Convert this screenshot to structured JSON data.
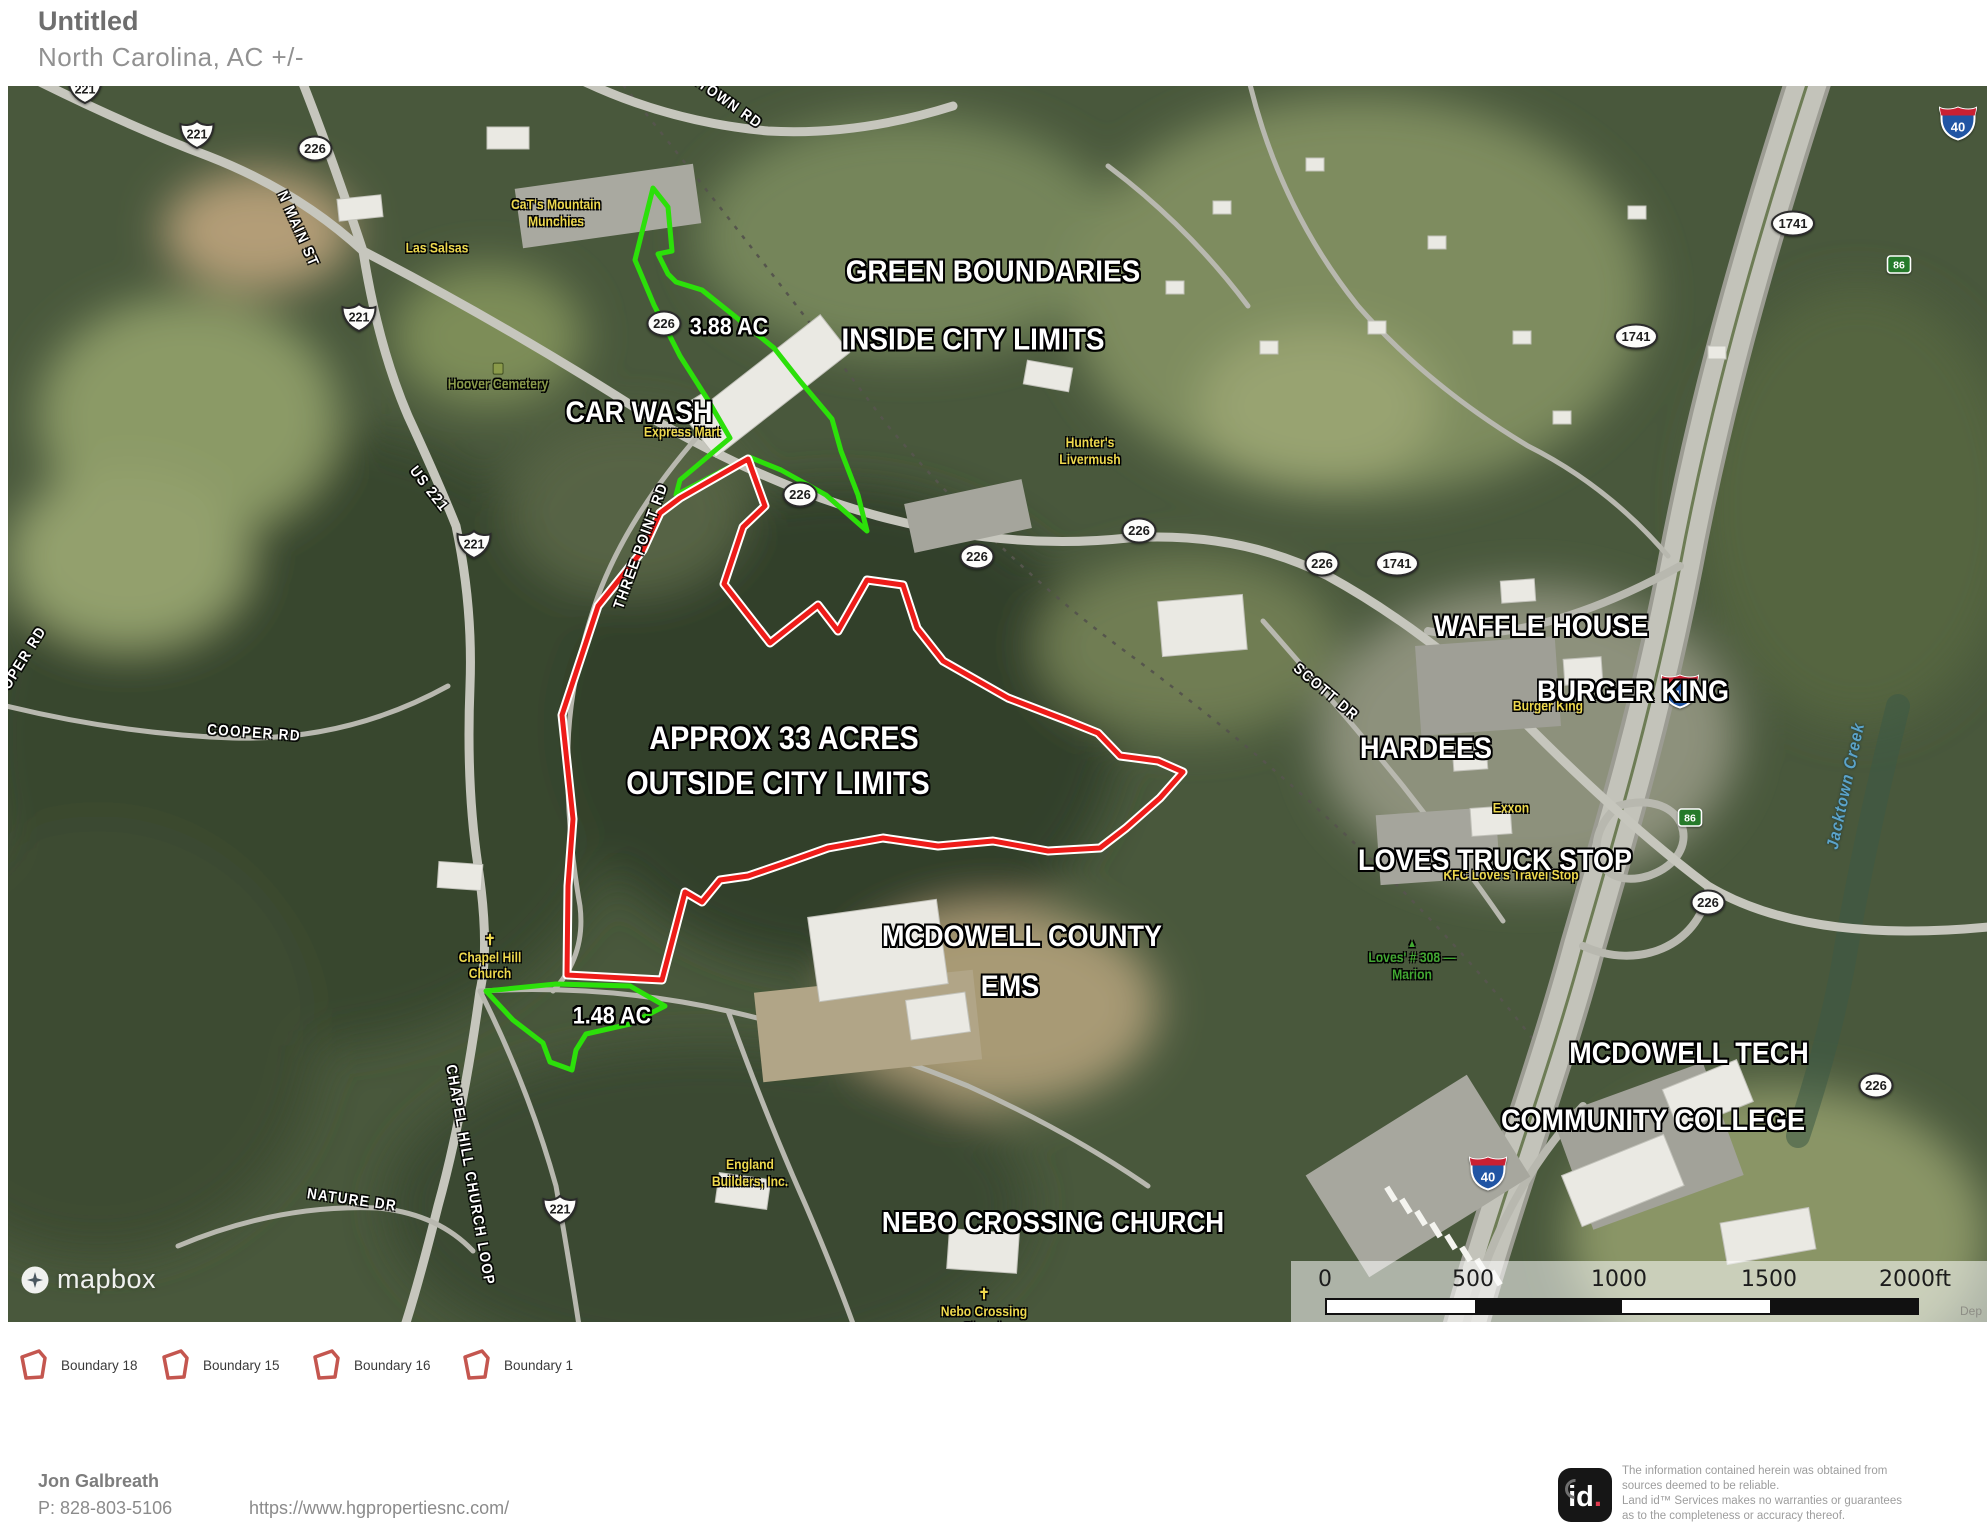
{
  "header": {
    "title": "Untitled",
    "subtitle": "North Carolina,  AC +/-"
  },
  "map": {
    "attribution": "mapbox",
    "area_labels": [
      {
        "text": "CAR WASH",
        "x": 631,
        "y": 327,
        "size": 30
      },
      {
        "text": "3.88 AC",
        "x": 721,
        "y": 242,
        "size": 24
      },
      {
        "text": "GREEN BOUNDARIES",
        "x": 985,
        "y": 186,
        "size": 31
      },
      {
        "text": "INSIDE CITY LIMITS",
        "x": 965,
        "y": 254,
        "size": 31
      },
      {
        "text": "APPROX 33 ACRES",
        "x": 776,
        "y": 653,
        "size": 32
      },
      {
        "text": "OUTSIDE CITY LIMITS",
        "x": 770,
        "y": 698,
        "size": 32
      },
      {
        "text": "MCDOWELL COUNTY",
        "x": 1014,
        "y": 851,
        "size": 30
      },
      {
        "text": "EMS",
        "x": 1002,
        "y": 901,
        "size": 30
      },
      {
        "text": "1.48 AC",
        "x": 604,
        "y": 931,
        "size": 24
      },
      {
        "text": "WAFFLE HOUSE",
        "x": 1533,
        "y": 541,
        "size": 30
      },
      {
        "text": "BURGER KING",
        "x": 1625,
        "y": 606,
        "size": 30
      },
      {
        "text": "HARDEES",
        "x": 1418,
        "y": 663,
        "size": 30
      },
      {
        "text": "LOVES TRUCK STOP",
        "x": 1487,
        "y": 775,
        "size": 30
      },
      {
        "text": "MCDOWELL TECH",
        "x": 1681,
        "y": 968,
        "size": 30
      },
      {
        "text": "COMMUNITY COLLEGE",
        "x": 1645,
        "y": 1035,
        "size": 30
      },
      {
        "text": "NEBO CROSSING CHURCH",
        "x": 1045,
        "y": 1137,
        "size": 29
      }
    ],
    "road_labels": [
      {
        "text": "JACKTOWN RD",
        "x": 705,
        "y": 6,
        "rot": 35
      },
      {
        "text": "N MAIN ST",
        "x": 290,
        "y": 143,
        "rot": 66
      },
      {
        "text": "US 221",
        "x": 421,
        "y": 403,
        "rot": 52
      },
      {
        "text": "THREE POINT RD",
        "x": 633,
        "y": 460,
        "rot": -70
      },
      {
        "text": "COOPER RD",
        "x": 246,
        "y": 647,
        "rot": 4
      },
      {
        "text": "OPER RD",
        "x": 16,
        "y": 572,
        "rot": -58
      },
      {
        "text": "SCOTT DR",
        "x": 1318,
        "y": 606,
        "rot": 40
      },
      {
        "text": "CHAPEL HILL CHURCH LOOP",
        "x": 462,
        "y": 1089,
        "rot": 80
      },
      {
        "text": "NATURE DR",
        "x": 344,
        "y": 1114,
        "rot": 8
      }
    ],
    "water_labels": [
      {
        "text": "Jacktown Creek",
        "x": 1838,
        "y": 700,
        "rot": -78
      }
    ],
    "poi_labels": [
      {
        "lines": [
          "Las Salsas"
        ],
        "x": 429,
        "y": 163,
        "color": "#eed94e"
      },
      {
        "lines": [
          "CaT's Mountain",
          "Munchies"
        ],
        "x": 548,
        "y": 128,
        "color": "#eed94e"
      },
      {
        "lines": [
          "Express Mart"
        ],
        "x": 674,
        "y": 347,
        "color": "#eed94e"
      },
      {
        "lines": [
          "Hunter's",
          "Livermush"
        ],
        "x": 1082,
        "y": 366,
        "color": "#eed94e"
      },
      {
        "lines": [
          "Burger King"
        ],
        "x": 1540,
        "y": 621,
        "color": "#eed94e"
      },
      {
        "lines": [
          "Exxon"
        ],
        "x": 1503,
        "y": 723,
        "color": "#eed94e"
      },
      {
        "lines": [
          "KFC  Love's Travel Stop"
        ],
        "x": 1503,
        "y": 790,
        "color": "#eed94e"
      },
      {
        "lines": [
          "Chapel Hill",
          "Church"
        ],
        "x": 482,
        "y": 872,
        "color": "#eed94e",
        "icon": "cross"
      },
      {
        "lines": [
          "England",
          "Builders, Inc."
        ],
        "x": 742,
        "y": 1088,
        "color": "#eed94e"
      },
      {
        "lines": [
          "Nebo Crossing",
          "Church"
        ],
        "x": 976,
        "y": 1226,
        "color": "#eed94e",
        "icon": "cross"
      },
      {
        "lines": [
          "Hoover Cemetery"
        ],
        "x": 490,
        "y": 292,
        "color": "#8a9a4a",
        "icon": "square"
      },
      {
        "lines": [
          "Loves' # 308 —",
          "Marion"
        ],
        "x": 1404,
        "y": 875,
        "color": "#42a832",
        "icon": "triangle"
      }
    ],
    "shields": [
      {
        "type": "us",
        "text": "221",
        "x": 77,
        "y": 6
      },
      {
        "type": "us",
        "text": "221",
        "x": 189,
        "y": 51
      },
      {
        "type": "oval",
        "text": "226",
        "x": 307,
        "y": 65
      },
      {
        "type": "us",
        "text": "221",
        "x": 351,
        "y": 234
      },
      {
        "type": "us",
        "text": "221",
        "x": 466,
        "y": 461
      },
      {
        "type": "oval",
        "text": "226",
        "x": 656,
        "y": 240
      },
      {
        "type": "oval",
        "text": "226",
        "x": 792,
        "y": 411
      },
      {
        "type": "oval",
        "text": "226",
        "x": 969,
        "y": 473
      },
      {
        "type": "oval",
        "text": "226",
        "x": 1131,
        "y": 447
      },
      {
        "type": "oval",
        "text": "226",
        "x": 1314,
        "y": 480
      },
      {
        "type": "oval",
        "text": "1741",
        "x": 1389,
        "y": 480
      },
      {
        "type": "oval",
        "text": "1741",
        "x": 1785,
        "y": 140
      },
      {
        "type": "oval",
        "text": "1741",
        "x": 1628,
        "y": 253
      },
      {
        "type": "interstate",
        "text": "40",
        "x": 1950,
        "y": 40
      },
      {
        "type": "interstate",
        "text": "40",
        "x": 1672,
        "y": 608
      },
      {
        "type": "interstate",
        "text": "40",
        "x": 1480,
        "y": 1090
      },
      {
        "type": "exit",
        "text": "86",
        "x": 1891,
        "y": 181
      },
      {
        "type": "exit",
        "text": "86",
        "x": 1682,
        "y": 734
      },
      {
        "type": "oval",
        "text": "226",
        "x": 1700,
        "y": 819
      },
      {
        "type": "oval",
        "text": "226",
        "x": 1868,
        "y": 1002
      },
      {
        "type": "us",
        "text": "221",
        "x": 552,
        "y": 1126
      }
    ],
    "boundaries": [
      {
        "id": "boundary-green-3-88-ac",
        "color": "#2ce00a",
        "width": 5,
        "points": "645,102 660,121 664,165 650,168 660,188 668,196 694,204 729,232 766,262 792,295 824,333 833,365 850,409 859,445 818,409 773,384 741,371 668,409 672,394 722,352 700,314 672,270 646,219 627,174"
      },
      {
        "id": "boundary-green-1-48-ac",
        "color": "#2ce00a",
        "width": 5,
        "points": "478,905 548,898 622,900 657,920 622,938 578,948 568,964 564,984 542,976 535,957 505,934"
      },
      {
        "id": "boundary-red-33-acres",
        "color": "#ee1c19",
        "width": 5,
        "casing": "#ffffff",
        "points": "672,412 740,373 757,420 735,441 716,498 762,557 810,519 830,545 859,494 895,499 909,542 935,575 1000,612 1060,635 1090,647 1112,670 1150,675 1175,686 1152,712 1118,742 1092,762 1040,765 985,755 930,760 875,752 820,762 775,778 740,790 712,794 694,816 677,806 654,894 559,889 560,800 565,733 554,629 590,520 635,464 652,427"
      }
    ],
    "scale_bar": {
      "ticks": [
        "0",
        "500",
        "1000",
        "1500",
        "2000ft"
      ]
    },
    "underlay_label": "Dep"
  },
  "legend": {
    "items": [
      {
        "label": "Boundary 18"
      },
      {
        "label": "Boundary 15"
      },
      {
        "label": "Boundary 16"
      },
      {
        "label": "Boundary 1"
      }
    ]
  },
  "footer": {
    "agent_name": "Jon  Galbreath",
    "phone": "P: 828-803-5106",
    "website": "https://www.hgpropertiesnc.com/",
    "logo_text": "id",
    "disclaimer_lines": [
      "The information contained herein was obtained from",
      "sources deemed to be reliable.",
      "  Land id™ Services makes no warranties or guarantees",
      "as to the completeness or accuracy thereof."
    ]
  }
}
